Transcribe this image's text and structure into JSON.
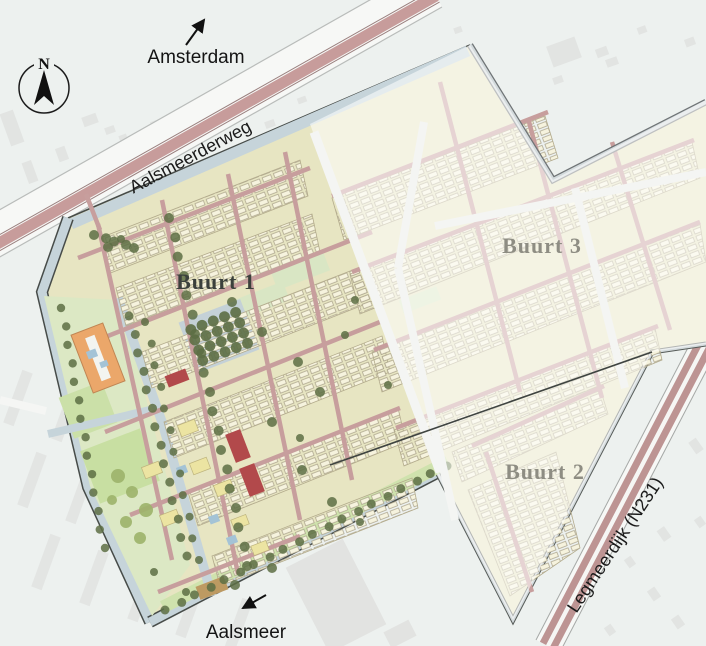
{
  "labels": {
    "north": "N",
    "amsterdam": "Amsterdam",
    "aalsmeer": "Aalsmeer",
    "road_top": "Aalsmeerderweg",
    "road_right": "Legmeerdijk (N231)",
    "district_1": "Buurt 1",
    "district_2": "Buurt 2",
    "district_3": "Buurt 3"
  },
  "colors": {
    "background": "#edf1ef",
    "road_pink": "#c79c9b",
    "road_casing": "#9a7f7e",
    "district_base": "#e7e5c2",
    "water": "#c6d4da",
    "greenery": "#cfe2ad",
    "tree": "#5d6e44",
    "accent_building_orange": "#eba76a",
    "accent_building_red": "#b2494b",
    "fade_overlay": "rgba(255,255,255,0.55)",
    "label_dark": "#3b403c",
    "label_faded": "#8e8d83"
  }
}
